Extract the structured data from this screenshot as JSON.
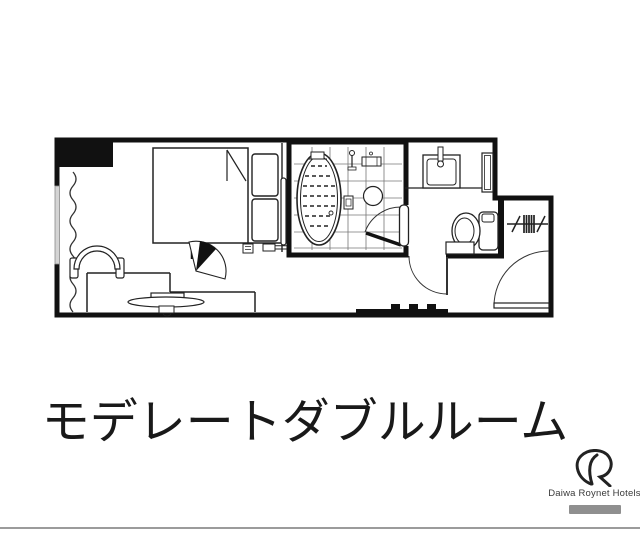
{
  "title": {
    "text": "モデレートダブルルーム"
  },
  "logo": {
    "brand": "Daiwa Roynet Hotels"
  },
  "palette": {
    "background": "#ffffff",
    "wall": "#111111",
    "line": "#222222",
    "grid": "#666666",
    "window_glass": "#d4d4d4",
    "bottom_rule": "#9b9b9b",
    "logo_tagline_box": "#8f8f8f"
  },
  "floorplan": {
    "type": "hotel-room-floor-plan",
    "rooms": [
      "bedroom",
      "unit-bathroom",
      "vanity-and-toilet-room",
      "open-closet",
      "entrance-corridor"
    ],
    "fixture_icons": [
      "pillar-icon",
      "window-icon",
      "curtain-icon",
      "double-bed-icon",
      "pillow-icon",
      "bedside-console-icon",
      "wall-panel-icon",
      "desk-icon",
      "chair-icon",
      "tv-icon",
      "swing-door-icon",
      "bathtub-icon",
      "bath-mat-icon",
      "shower-icon",
      "bath-shelf-icon",
      "bath-stool-icon",
      "tile-grid-icon",
      "washbasin-icon",
      "faucet-icon",
      "shelf-icon",
      "toilet-icon",
      "step-box-icon",
      "hanger-rack-icon",
      "door-swing-arc-icon",
      "entrance-sill-icon"
    ]
  }
}
